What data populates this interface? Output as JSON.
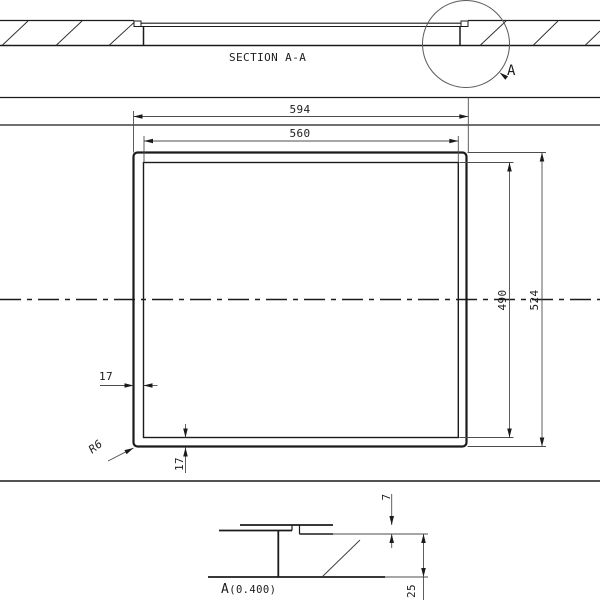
{
  "section": {
    "label": "SECTION A-A",
    "detail_marker": "A"
  },
  "plan": {
    "dim_outer_width": "594",
    "dim_inner_width": "560",
    "dim_inner_height": "490",
    "dim_outer_height": "524",
    "dim_left_offset": "17",
    "dim_bottom_offset": "17",
    "radius_callout": "R6"
  },
  "detail": {
    "name": "A",
    "scale": "(0.400)",
    "dim_lip_height": "7",
    "dim_depth": "25"
  },
  "colors": {
    "line": "#1b1b1b",
    "thin_line": "#4d4d4d",
    "background": "#ffffff"
  }
}
